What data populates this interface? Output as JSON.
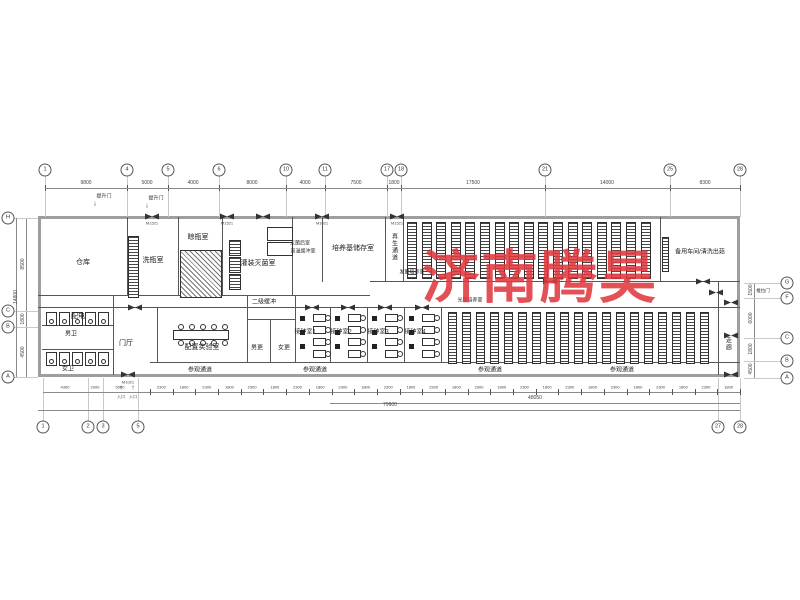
{
  "watermark": {
    "text": "济南腾昊",
    "color": "#e0383e"
  },
  "grid": {
    "top": [
      "1",
      "4",
      "5",
      "6",
      "10",
      "11",
      "17",
      "18",
      "21",
      "25",
      "28"
    ],
    "top_dims": [
      "9800",
      "5000",
      "4000",
      "8000",
      "4000",
      "7500",
      "1800",
      "17500",
      "14000",
      "8300"
    ],
    "left": [
      "H",
      "C",
      "B",
      "A"
    ],
    "left_dims": [
      "8500",
      "1800",
      "4500"
    ],
    "left_total": "14800",
    "right": [
      "G",
      "F",
      "C",
      "B",
      "A"
    ],
    "right_dims": [
      "1500",
      "6000",
      "1800",
      "4500"
    ],
    "bottom_left": [
      "1",
      "2",
      "3",
      "5"
    ],
    "bottom_left_dims": [
      "4300",
      "2000",
      "5000"
    ],
    "bottom_row_values": [
      "2300",
      "1800"
    ],
    "bottom_subtotal": "48050",
    "bottom_total": "79900"
  },
  "rooms": {
    "warehouse": "仓库",
    "bottle_wash": "洗瓶室",
    "bottle_dry": "晾瓶室",
    "fill_sterilize": "灌装灭菌室",
    "medium_storage": "培养基储存室",
    "regen_corridor": "再生通道",
    "spawn_culture": "发菌培养室",
    "spare_workshop": "备用车间/清洗出菇",
    "power": "配电",
    "mens_wc": "男卫",
    "womens_wc": "女卫",
    "lobby": "门厅",
    "prep_lab": "配置实验室",
    "secondary_buffer": "二级缓冲",
    "mens_change": "男更",
    "womens_change": "女更",
    "inoculation_1": "接种室1",
    "inoculation_2": "接种室2",
    "inoculation_3": "接种室3",
    "inoculation_4": "接种室4",
    "light_culture": "光照培养室",
    "visit_corridor": "参观通道",
    "corridor": "走廊"
  },
  "notes": {
    "lift_door": "提升门",
    "entrance": "入口",
    "sliding_door": "推拉门",
    "post_sterilize": "灭菌后室",
    "high_temp_buffer": "高温缓冲室",
    "door_code_a": "M1521",
    "door_code_b": "M1021"
  }
}
